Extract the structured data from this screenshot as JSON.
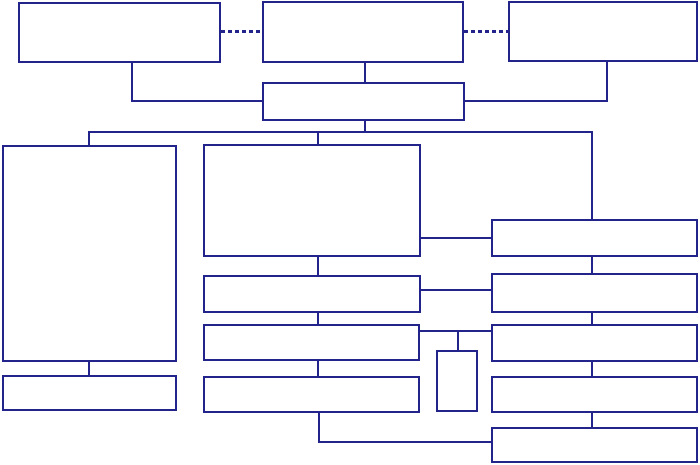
{
  "diagram": {
    "canvas": {
      "width": 700,
      "height": 465,
      "background": "#ffffff"
    },
    "style": {
      "line_color": "#23238C",
      "line_width": 2,
      "dash_thickness": 3,
      "box_fill": "#ffffff"
    },
    "boxes": [
      {
        "id": "top-box-1",
        "label": "",
        "x": 18,
        "y": 2,
        "w": 203,
        "h": 61
      },
      {
        "id": "top-box-2",
        "label": "",
        "x": 262,
        "y": 1,
        "w": 202,
        "h": 62
      },
      {
        "id": "top-box-3",
        "label": "",
        "x": 508,
        "y": 1,
        "w": 190,
        "h": 61
      },
      {
        "id": "junction-box",
        "label": "",
        "x": 262,
        "y": 82,
        "w": 203,
        "h": 39
      },
      {
        "id": "left-tall-box",
        "label": "",
        "x": 2,
        "y": 145,
        "w": 175,
        "h": 217
      },
      {
        "id": "left-bottom-box",
        "label": "",
        "x": 2,
        "y": 375,
        "w": 175,
        "h": 36
      },
      {
        "id": "mid-box-1",
        "label": "",
        "x": 203,
        "y": 144,
        "w": 218,
        "h": 113
      },
      {
        "id": "mid-box-2",
        "label": "",
        "x": 203,
        "y": 275,
        "w": 218,
        "h": 38
      },
      {
        "id": "mid-box-3",
        "label": "",
        "x": 203,
        "y": 324,
        "w": 217,
        "h": 37
      },
      {
        "id": "mid-box-4",
        "label": "",
        "x": 203,
        "y": 376,
        "w": 217,
        "h": 37
      },
      {
        "id": "small-box",
        "label": "",
        "x": 436,
        "y": 350,
        "w": 42,
        "h": 62
      },
      {
        "id": "right-box-1",
        "label": "",
        "x": 491,
        "y": 219,
        "w": 207,
        "h": 38
      },
      {
        "id": "right-box-2",
        "label": "",
        "x": 491,
        "y": 273,
        "w": 207,
        "h": 40
      },
      {
        "id": "right-box-3",
        "label": "",
        "x": 491,
        "y": 324,
        "w": 207,
        "h": 38
      },
      {
        "id": "right-box-4",
        "label": "",
        "x": 491,
        "y": 376,
        "w": 207,
        "h": 37
      },
      {
        "id": "right-box-5",
        "label": "",
        "x": 491,
        "y": 427,
        "w": 207,
        "h": 36
      }
    ],
    "connectors": [
      {
        "id": "dashed-link-1",
        "type": "dashed-h",
        "x": 221,
        "y": 30,
        "len": 41
      },
      {
        "id": "dashed-link-2",
        "type": "dashed-h",
        "x": 464,
        "y": 30,
        "len": 44
      },
      {
        "id": "top1-drop",
        "type": "v",
        "x": 131,
        "y": 63,
        "len": 39
      },
      {
        "id": "top1-elbow",
        "type": "h",
        "x": 131,
        "y": 100,
        "len": 132
      },
      {
        "id": "top2-drop",
        "type": "v",
        "x": 364,
        "y": 63,
        "len": 20
      },
      {
        "id": "top3-drop",
        "type": "v",
        "x": 606,
        "y": 62,
        "len": 40
      },
      {
        "id": "top3-elbow",
        "type": "h",
        "x": 464,
        "y": 100,
        "len": 143
      },
      {
        "id": "junction-drop",
        "type": "v",
        "x": 364,
        "y": 121,
        "len": 11
      },
      {
        "id": "bus-line",
        "type": "h",
        "x": 88,
        "y": 131,
        "len": 505
      },
      {
        "id": "bus-drop-left",
        "type": "v",
        "x": 88,
        "y": 131,
        "len": 15
      },
      {
        "id": "bus-drop-mid",
        "type": "v",
        "x": 317,
        "y": 131,
        "len": 14
      },
      {
        "id": "bus-drop-right",
        "type": "v",
        "x": 591,
        "y": 131,
        "len": 89
      },
      {
        "id": "left-tick",
        "type": "v",
        "x": 88,
        "y": 361,
        "len": 15
      },
      {
        "id": "mid-tick-1",
        "type": "v",
        "x": 317,
        "y": 256,
        "len": 20
      },
      {
        "id": "mid-tick-2",
        "type": "v",
        "x": 317,
        "y": 312,
        "len": 13
      },
      {
        "id": "mid-tick-3",
        "type": "v",
        "x": 317,
        "y": 360,
        "len": 17
      },
      {
        "id": "mid-elbow-vert",
        "type": "v",
        "x": 318,
        "y": 412,
        "len": 31
      },
      {
        "id": "mid-elbow-horiz",
        "type": "h",
        "x": 318,
        "y": 441,
        "len": 175
      },
      {
        "id": "mid-right-link-1",
        "type": "h",
        "x": 420,
        "y": 237,
        "len": 72
      },
      {
        "id": "mid-right-link-2",
        "type": "h",
        "x": 420,
        "y": 289,
        "len": 72
      },
      {
        "id": "mid-right-link-3",
        "type": "h",
        "x": 419,
        "y": 330,
        "len": 73
      },
      {
        "id": "small-box-drop",
        "type": "v",
        "x": 457,
        "y": 331,
        "len": 20
      },
      {
        "id": "right-tick-1",
        "type": "v",
        "x": 591,
        "y": 256,
        "len": 18
      },
      {
        "id": "right-tick-2",
        "type": "v",
        "x": 591,
        "y": 313,
        "len": 12
      },
      {
        "id": "right-tick-3",
        "type": "v",
        "x": 591,
        "y": 361,
        "len": 16
      },
      {
        "id": "right-tick-4",
        "type": "v",
        "x": 591,
        "y": 412,
        "len": 16
      }
    ]
  }
}
